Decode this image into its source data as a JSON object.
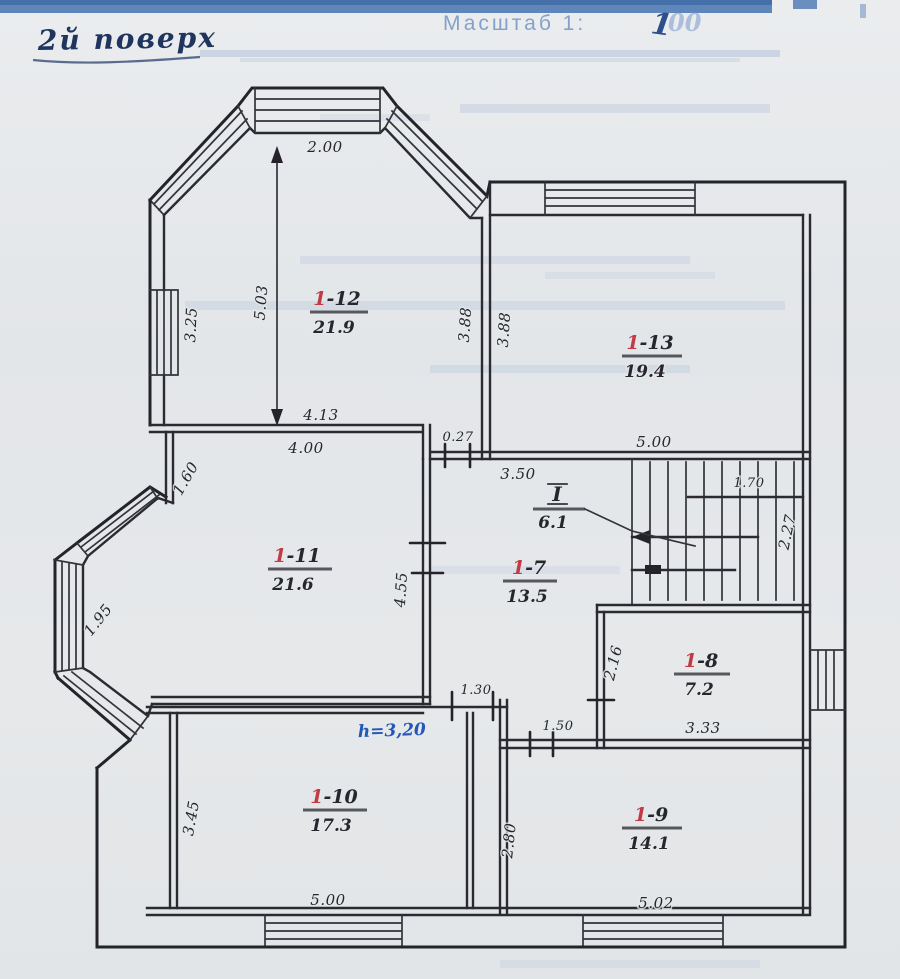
{
  "header": {
    "floor_label": "2й поверх",
    "scale_label": "Масштаб 1:",
    "scale_value": "100",
    "scale_value_leading": "1",
    "scale_value_trailing": "00"
  },
  "plan": {
    "rooms": {
      "r12": {
        "prefix": "1",
        "rest": "-12",
        "area": "21.9"
      },
      "r13": {
        "prefix": "1",
        "rest": "-13",
        "area": "19.4"
      },
      "r11": {
        "prefix": "1",
        "rest": "-11",
        "area": "21.6"
      },
      "r7": {
        "prefix": "1",
        "rest": "-7",
        "area": "13.5"
      },
      "r8": {
        "prefix": "1",
        "rest": "-8",
        "area": "7.2"
      },
      "r9": {
        "prefix": "1",
        "rest": "-9",
        "area": "14.1"
      },
      "r10": {
        "prefix": "1",
        "rest": "-10",
        "area": "17.3"
      }
    },
    "stairwell": {
      "label": "I",
      "area": "6.1"
    },
    "height_note": "h=3,20",
    "dims": {
      "bay_top_width": "2.00",
      "r12_height": "5.03",
      "r12_left": "3.25",
      "r12_right": "3.88",
      "r13_left": "3.88",
      "r12_bottom": "4.13",
      "r11_top": "4.00",
      "wall_offset": "0.27",
      "r7_top": "3.50",
      "r13_bottom": "5.00",
      "stair_width": "1.70",
      "stair_height": "2.27",
      "r11_corner": "1.60",
      "r11_right": "4.55",
      "bay_left": "1.95",
      "r8_left": "2.16",
      "r8_bottom": "3.33",
      "door_r10": "1.30",
      "door_r9": "1.50",
      "r9_left": "2.80",
      "r10_left": "3.45",
      "r10_bottom": "5.00",
      "r9_bottom": "5.02"
    }
  },
  "colors": {
    "ink": "#2a2a30",
    "room_number_accent": "#c13a44",
    "height_note_blue": "#2458b8",
    "header_band_blue": "#3f6fae",
    "paper": "#e4e7e9"
  }
}
